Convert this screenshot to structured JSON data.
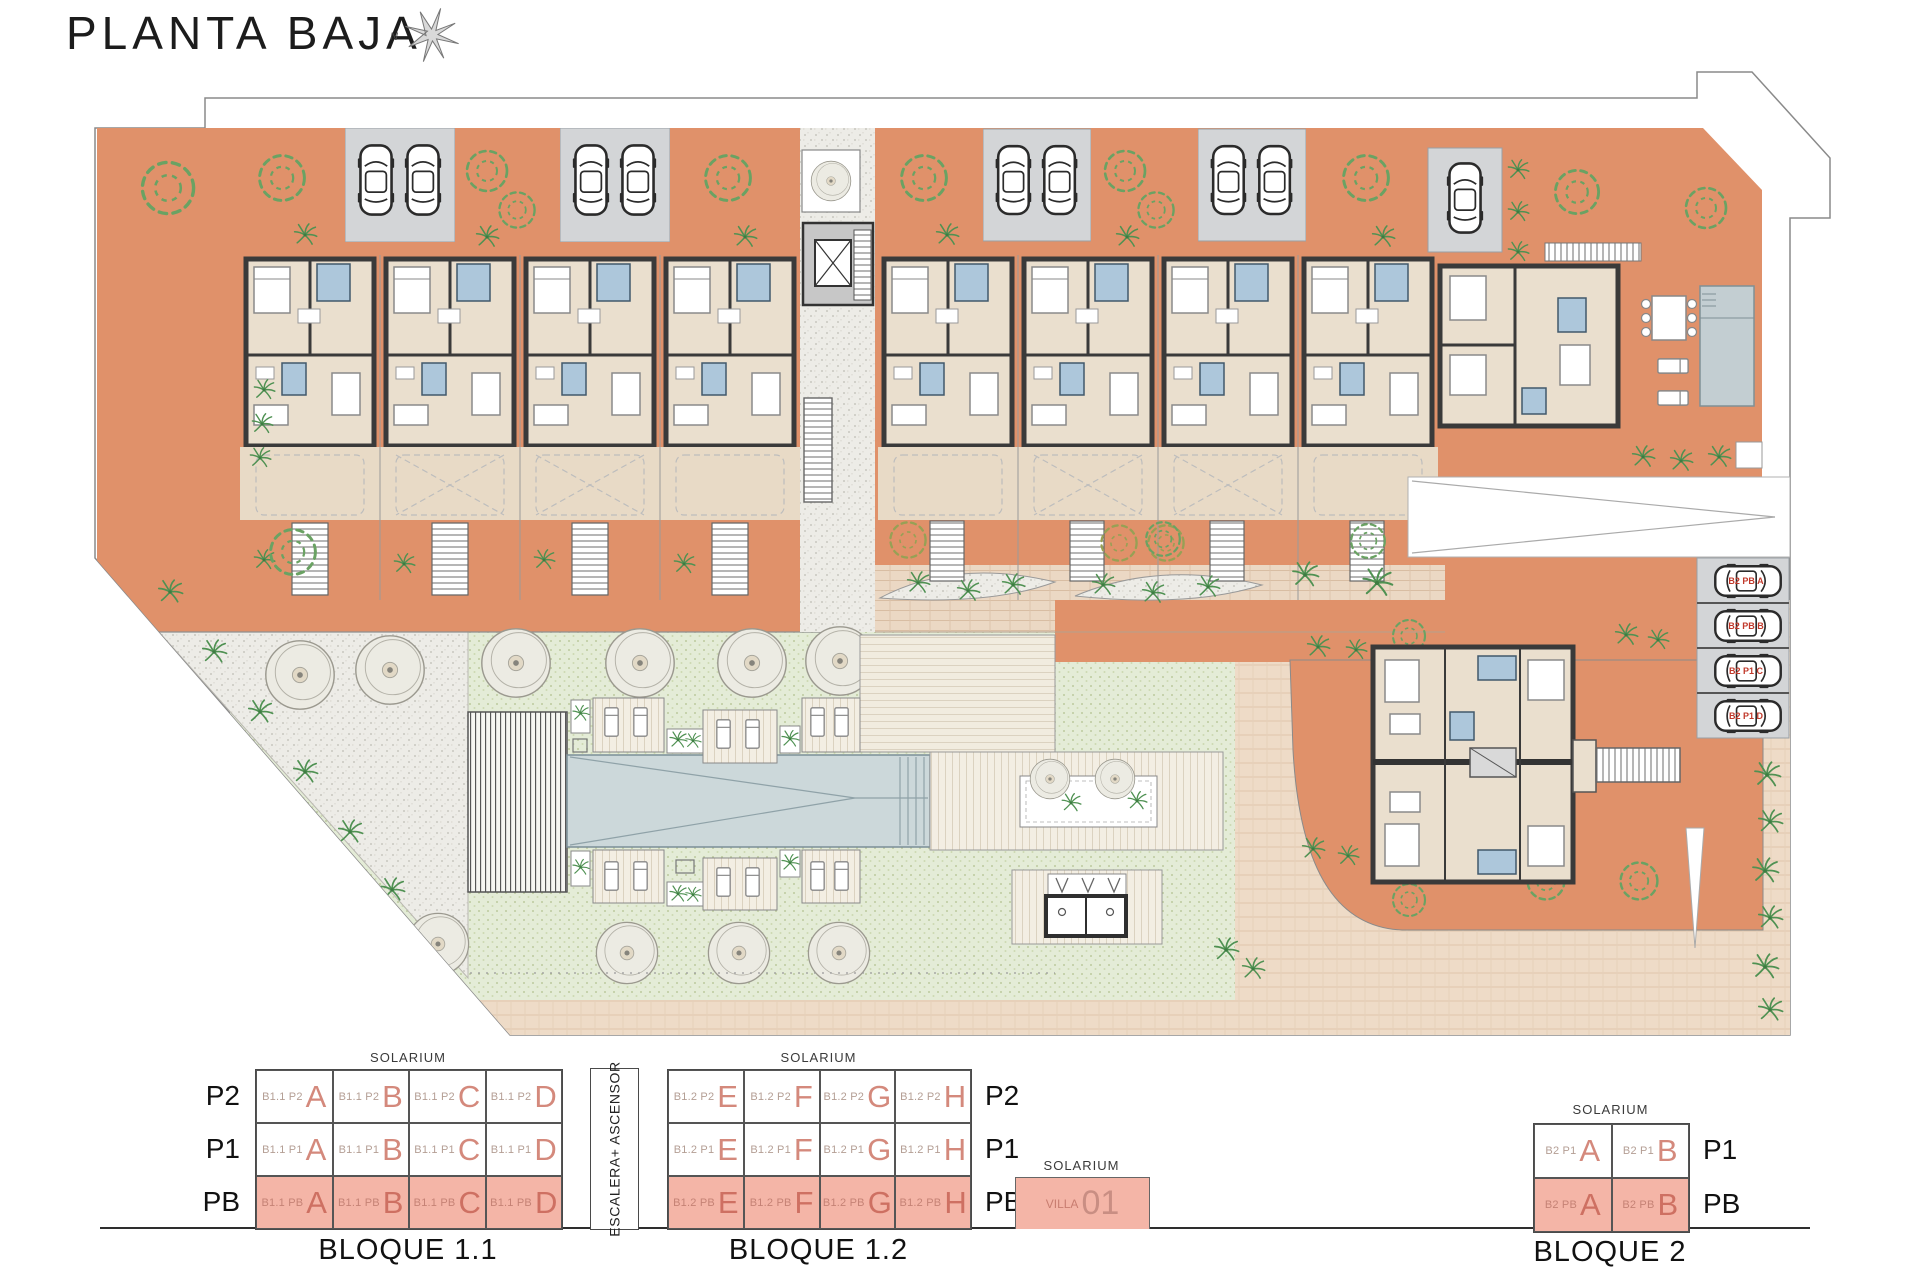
{
  "title": "PLANTA BAJA",
  "compass": {
    "north_label": "N"
  },
  "plan": {
    "parking_labels": [
      "B2 PB A",
      "B2 PB B",
      "B2 P1 C",
      "B2 P1 D"
    ]
  },
  "diagrams": {
    "bloque11": {
      "name": "BLOQUE 1.1",
      "solarium": "SOLARIUM",
      "row_labels": [
        "P2",
        "P1",
        "PB"
      ],
      "rows": [
        {
          "cells": [
            {
              "prefix": "B1.1 P2",
              "letter": "A"
            },
            {
              "prefix": "B1.1 P2",
              "letter": "B"
            },
            {
              "prefix": "B1.1 P2",
              "letter": "C"
            },
            {
              "prefix": "B1.1 P2",
              "letter": "D"
            }
          ]
        },
        {
          "cells": [
            {
              "prefix": "B1.1 P1",
              "letter": "A"
            },
            {
              "prefix": "B1.1 P1",
              "letter": "B"
            },
            {
              "prefix": "B1.1 P1",
              "letter": "C"
            },
            {
              "prefix": "B1.1 P1",
              "letter": "D"
            }
          ]
        },
        {
          "cells": [
            {
              "prefix": "B1.1 PB",
              "letter": "A"
            },
            {
              "prefix": "B1.1 PB",
              "letter": "B"
            },
            {
              "prefix": "B1.1 PB",
              "letter": "C"
            },
            {
              "prefix": "B1.1 PB",
              "letter": "D"
            }
          ]
        }
      ]
    },
    "stair_core_label": "ESCALERA+ ASCENSOR",
    "bloque12": {
      "name": "BLOQUE 1.2",
      "solarium": "SOLARIUM",
      "row_labels": [
        "P2",
        "P1",
        "PB"
      ],
      "rows": [
        {
          "cells": [
            {
              "prefix": "B1.2 P2",
              "letter": "E"
            },
            {
              "prefix": "B1.2 P2",
              "letter": "F"
            },
            {
              "prefix": "B1.2 P2",
              "letter": "G"
            },
            {
              "prefix": "B1.2 P2",
              "letter": "H"
            }
          ]
        },
        {
          "cells": [
            {
              "prefix": "B1.2 P1",
              "letter": "E"
            },
            {
              "prefix": "B1.2 P1",
              "letter": "F"
            },
            {
              "prefix": "B1.2 P1",
              "letter": "G"
            },
            {
              "prefix": "B1.2 P1",
              "letter": "H"
            }
          ]
        },
        {
          "cells": [
            {
              "prefix": "B1.2 PB",
              "letter": "E"
            },
            {
              "prefix": "B1.2 PB",
              "letter": "F"
            },
            {
              "prefix": "B1.2 PB",
              "letter": "G"
            },
            {
              "prefix": "B1.2 PB",
              "letter": "H"
            }
          ]
        }
      ]
    },
    "villa": {
      "solarium": "SOLARIUM",
      "prefix": "VILLA",
      "number": "01"
    },
    "bloque2": {
      "name": "BLOQUE 2",
      "solarium": "SOLARIUM",
      "row_labels": [
        "P1",
        "PB"
      ],
      "rows": [
        {
          "cells": [
            {
              "prefix": "B2 P1",
              "letter": "A"
            },
            {
              "prefix": "B2 P1",
              "letter": "B"
            }
          ]
        },
        {
          "cells": [
            {
              "prefix": "B2 PB",
              "letter": "A"
            },
            {
              "prefix": "B2 PB",
              "letter": "B"
            }
          ]
        }
      ]
    }
  }
}
